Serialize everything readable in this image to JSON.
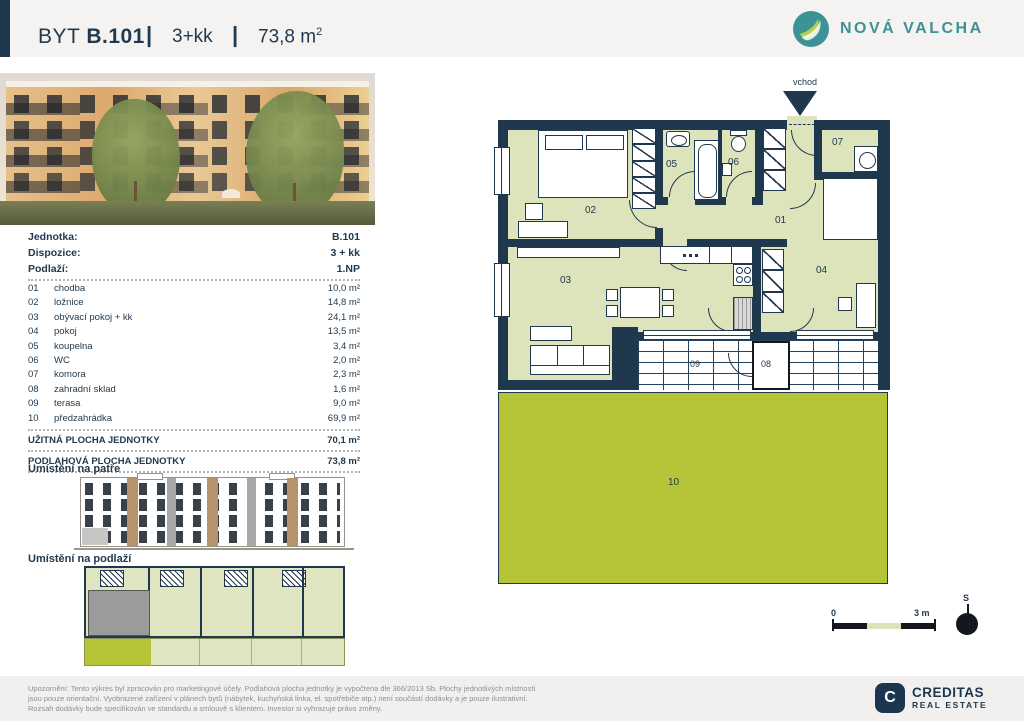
{
  "header": {
    "prefix": "BYT",
    "unit": "B.101",
    "sep": "|",
    "disposition": "3+kk",
    "area": "73,8 m",
    "area_sup": "2",
    "brand": "NOVÁ VALCHA"
  },
  "info": {
    "meta": [
      {
        "label": "Jednotka:",
        "value": "B.101"
      },
      {
        "label": "Dispozice:",
        "value": "3 + kk"
      },
      {
        "label": "Podlaží:",
        "value": "1.NP"
      }
    ],
    "rooms": [
      {
        "num": "01",
        "name": "chodba",
        "area": "10,0 m²"
      },
      {
        "num": "02",
        "name": "ložnice",
        "area": "14,8 m²"
      },
      {
        "num": "03",
        "name": "obývací pokoj + kk",
        "area": "24,1 m²"
      },
      {
        "num": "04",
        "name": "pokoj",
        "area": "13,5 m²"
      },
      {
        "num": "05",
        "name": "koupelna",
        "area": "3,4 m²"
      },
      {
        "num": "06",
        "name": "WC",
        "area": "2,0 m²"
      },
      {
        "num": "07",
        "name": "komora",
        "area": "2,3 m²"
      },
      {
        "num": "08",
        "name": "zahradní sklad",
        "area": "1,6 m²"
      },
      {
        "num": "09",
        "name": "terasa",
        "area": "9,0 m²"
      },
      {
        "num": "10",
        "name": "předzahrádka",
        "area": "69,9 m²"
      }
    ],
    "totals": [
      {
        "label": "UŽITNÁ PLOCHA JEDNOTKY",
        "area": "70,1 m²"
      },
      {
        "label": "PODLAHOVÁ PLOCHA JEDNOTKY",
        "area": "73,8 m²"
      }
    ]
  },
  "sections": {
    "floor": "Umístění na patře",
    "level": "Umístění na podlaží"
  },
  "plan": {
    "entrance": "vchod",
    "labels": {
      "n01": "01",
      "n02": "02",
      "n03": "03",
      "n04": "04",
      "n05": "05",
      "n06": "06",
      "n07": "07",
      "n08": "08",
      "n09": "09",
      "n10": "10"
    },
    "scale": {
      "start": "0",
      "end": "3 m"
    },
    "compass": "S"
  },
  "footer": {
    "line1": "Upozornění: Tento výkres byl zpracován pro marketingové účely. Podlahová plocha jednotky je vypočtena dle 366/2013 Sb. Plochy jednotlivých místností",
    "line2": "jsou pouze orientační. Vyobrazené zařízení v plánech bytů (nábytek, kuchyňská linka, el. spotřebiče atp.) není součástí dodávky a je pouze ilustrativní.",
    "line3": "Rozsah dodávky bude specifikován ve standardu a smlouvě s klientem. Investor si vyhrazuje právo změny.",
    "creditas": {
      "letter": "C",
      "name": "CREDITAS",
      "subtitle": "REAL ESTATE"
    }
  },
  "colors": {
    "navy": "#20384e",
    "sage": "#dde3ba",
    "garden": "#b5c337",
    "teal": "#3d9296",
    "leaf": "#b8d14d"
  }
}
